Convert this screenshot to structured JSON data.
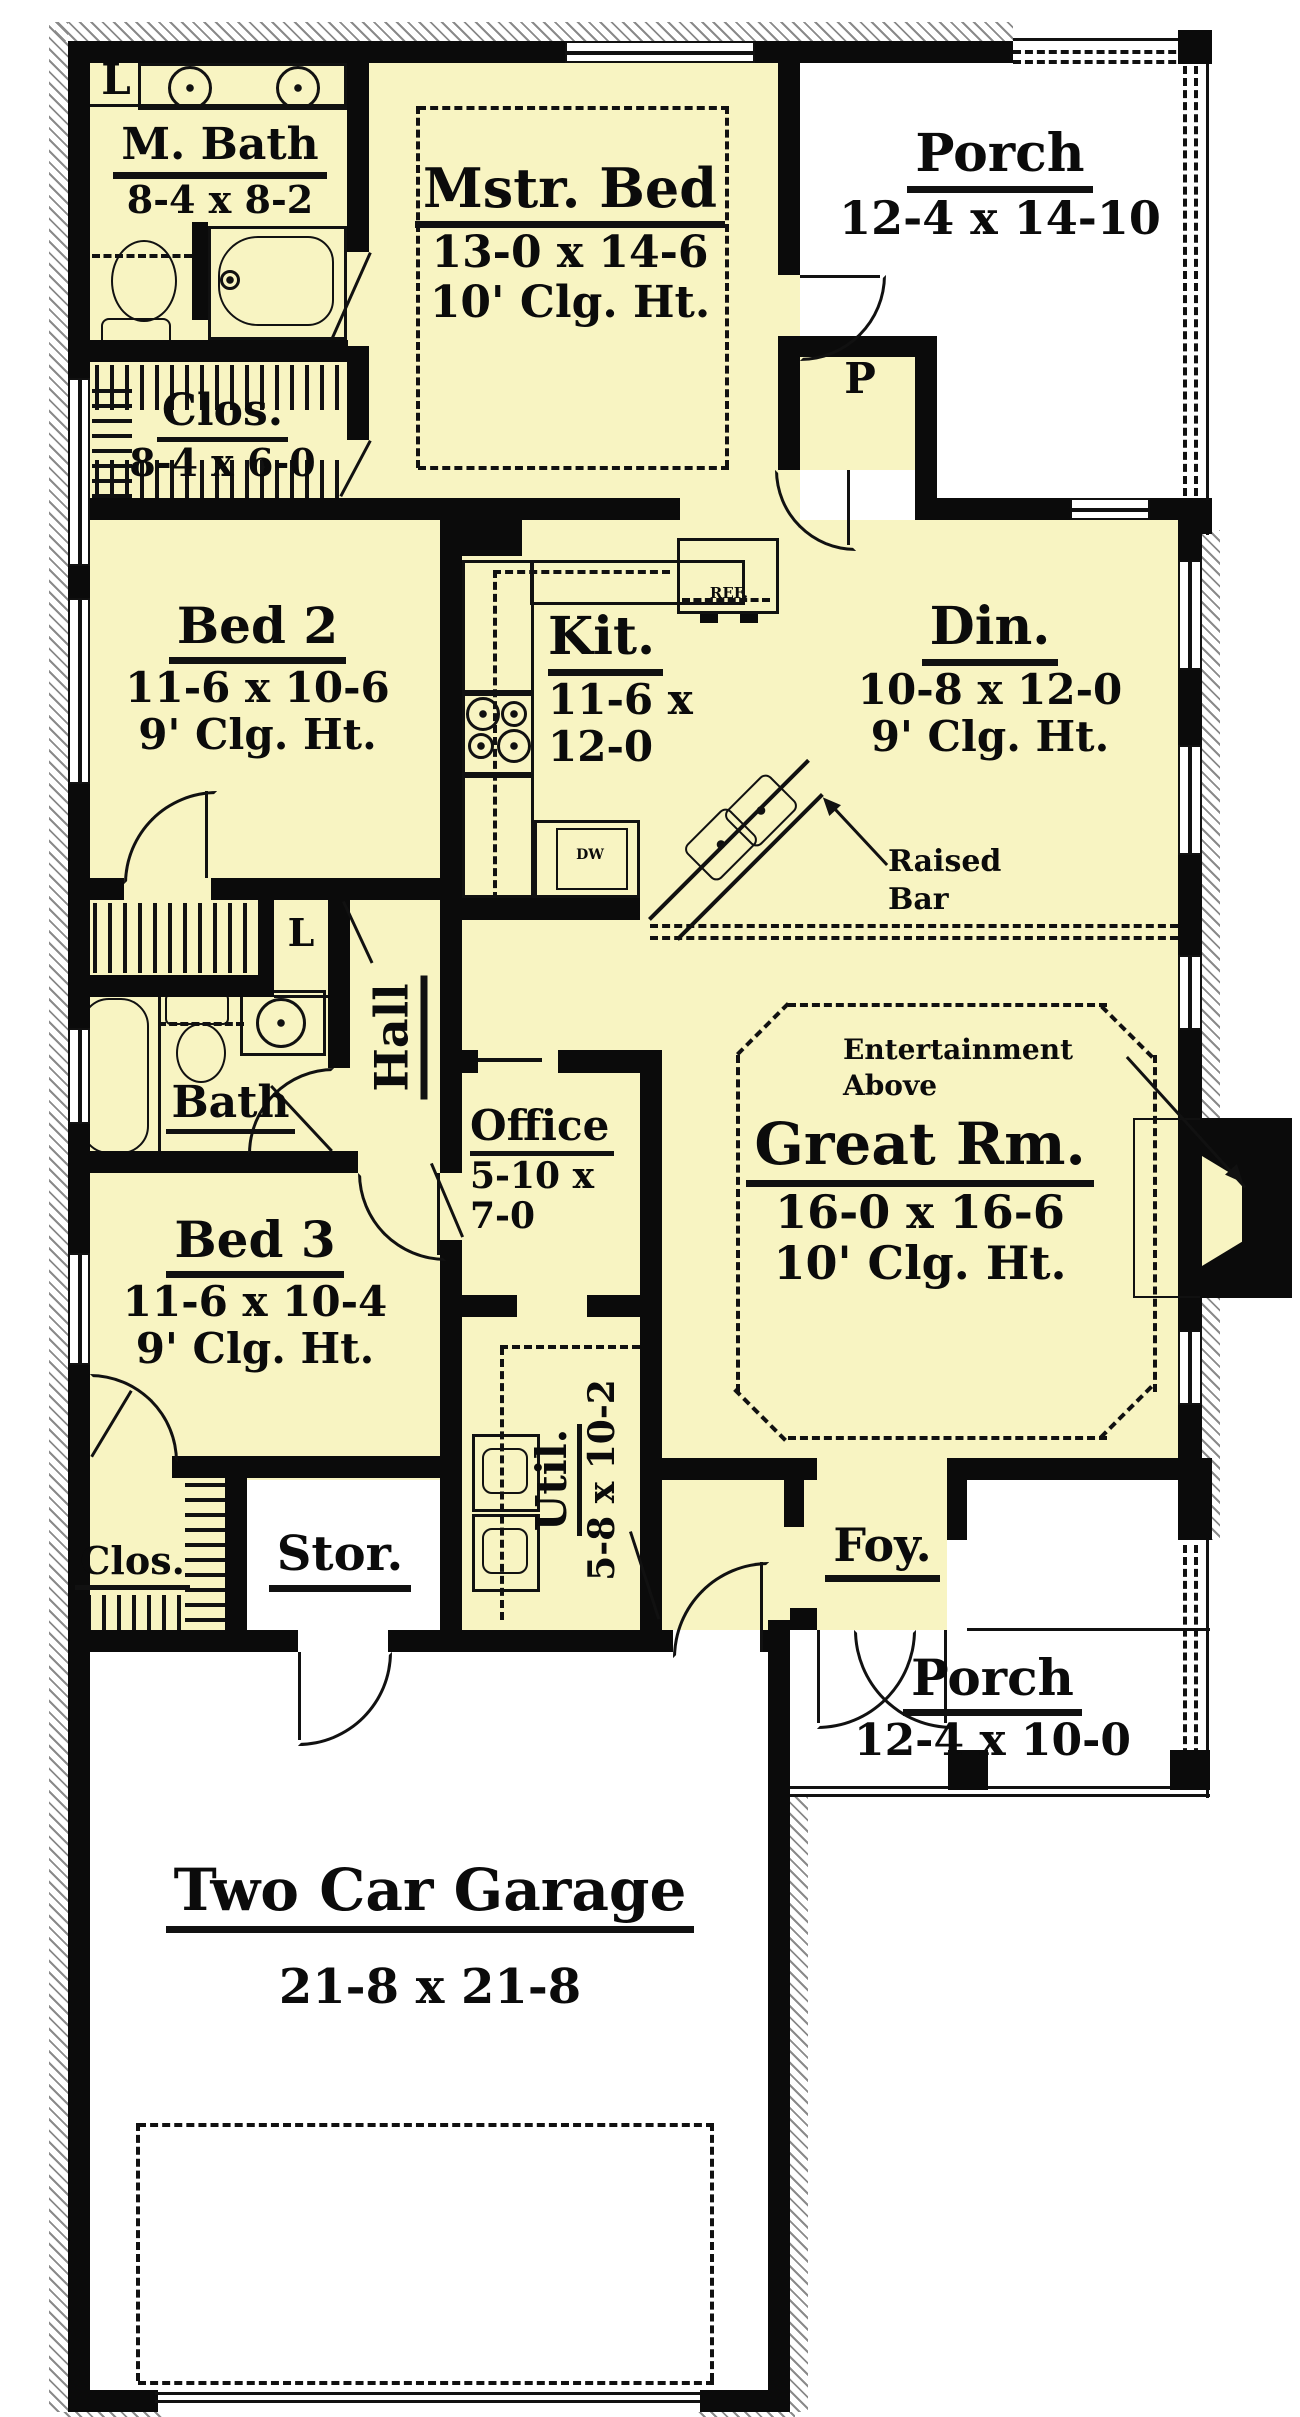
{
  "plan": {
    "rooms": {
      "m_bath": {
        "label": "M. Bath",
        "dims": "8-4 x 8-2"
      },
      "linen_top": {
        "label": "L"
      },
      "closet_master": {
        "label": "Clos.",
        "dims": "8-4 x 6-0"
      },
      "master_bed": {
        "label": "Mstr. Bed",
        "dims": "13-0 x 14-6",
        "ceiling": "10' Clg. Ht."
      },
      "porch_top": {
        "label": "Porch",
        "dims": "12-4 x 14-10"
      },
      "pantry": {
        "label": "P"
      },
      "bed2": {
        "label": "Bed 2",
        "dims": "11-6 x 10-6",
        "ceiling": "9' Clg. Ht."
      },
      "kitchen": {
        "label": "Kit.",
        "dims1": "11-6 x",
        "dims2": "12-0"
      },
      "dining": {
        "label": "Din.",
        "dims": "10-8 x 12-0",
        "ceiling": "9' Clg. Ht."
      },
      "hall": {
        "label": "Hall"
      },
      "linen_hall": {
        "label": "L"
      },
      "bath": {
        "label": "Bath"
      },
      "office": {
        "label": "Office",
        "dims1": "5-10 x",
        "dims2": "7-0"
      },
      "great_room": {
        "label": "Great Rm.",
        "dims": "16-0 x 16-6",
        "ceiling": "10' Clg. Ht."
      },
      "bed3": {
        "label": "Bed 3",
        "dims": "11-6 x 10-4",
        "ceiling": "9' Clg. Ht."
      },
      "utility": {
        "label": "Util.",
        "dims": "5-8 x 10-2"
      },
      "closet_bed3": {
        "label": "Clos."
      },
      "storage": {
        "label": "Stor."
      },
      "foyer": {
        "label": "Foy."
      },
      "porch_bottom": {
        "label": "Porch",
        "dims": "12-4 x 10-0"
      },
      "garage": {
        "label": "Two Car Garage",
        "dims": "21-8 x 21-8"
      }
    },
    "annotations": {
      "raised_1": "Raised",
      "raised_2": "Bar",
      "ent_1": "Entertainment",
      "ent_2": "Above",
      "fridge": "REF.",
      "dishwasher": "DW"
    },
    "colors": {
      "wall": "#0b0b0b",
      "interior": "#f8f4c2",
      "exterior": "#ffffff",
      "hatch": "#8a8a8a"
    }
  }
}
